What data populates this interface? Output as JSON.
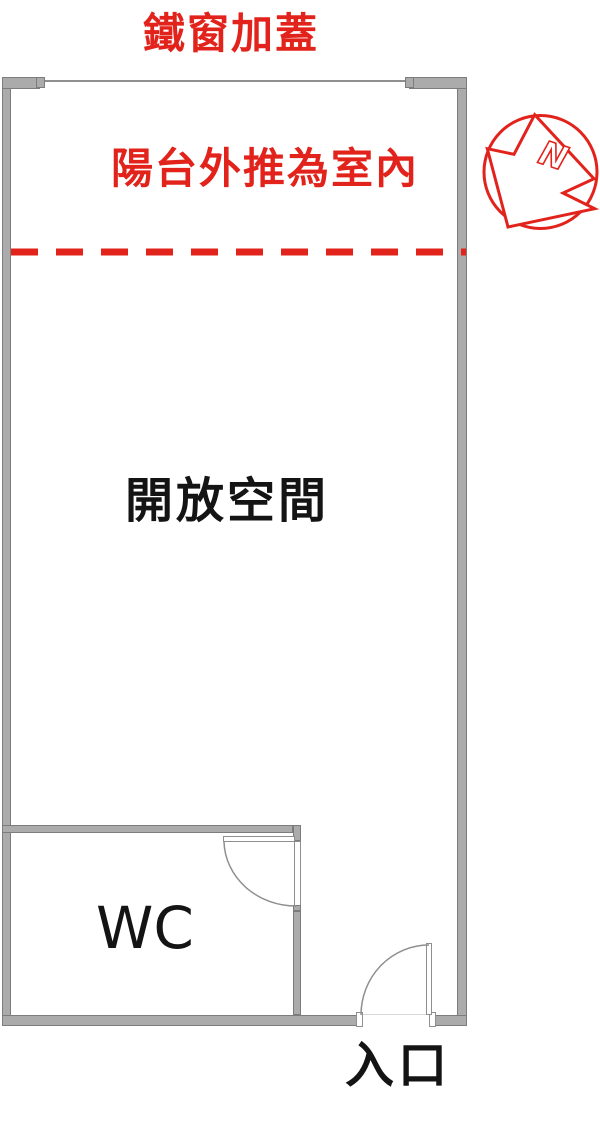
{
  "floorplan": {
    "labels": {
      "top_annotation": "鐵窗加蓋",
      "balcony_annotation": "陽台外推為室內",
      "open_space": "開放空間",
      "wc": "WC",
      "entrance": "入口"
    },
    "compass": {
      "letter": "N"
    },
    "colors": {
      "annotation_red": "#e2231c",
      "wall_fill": "#ababab",
      "wall_edge": "#7c7c7c",
      "door_line": "#8f8f8f",
      "text_black": "#141414"
    }
  }
}
